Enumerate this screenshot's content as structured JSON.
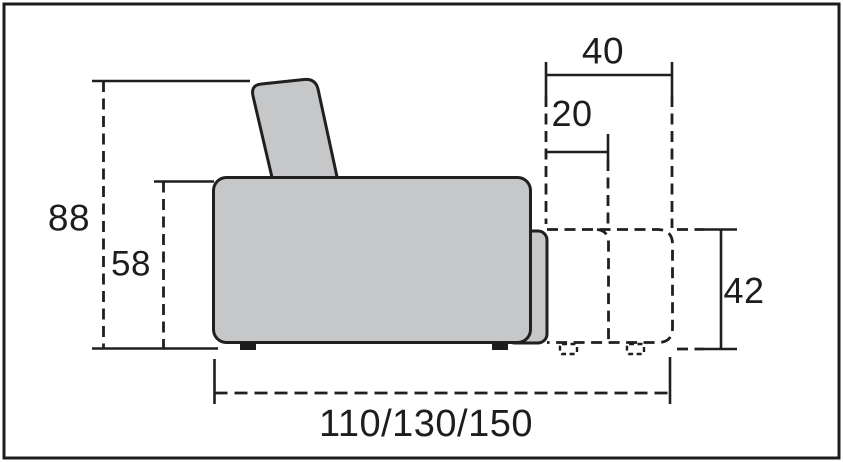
{
  "figure": {
    "type": "furniture-dimension-diagram",
    "labels": {
      "height_total": "88",
      "height_seat_arm": "58",
      "depth_backrest_top": "40",
      "depth_overhang": "20",
      "height_extension": "42",
      "width_variants": "110/130/150"
    },
    "colors": {
      "outline": "#1f1f1f",
      "upholstery_fill": "#c6c7c9",
      "background": "#ffffff"
    }
  }
}
